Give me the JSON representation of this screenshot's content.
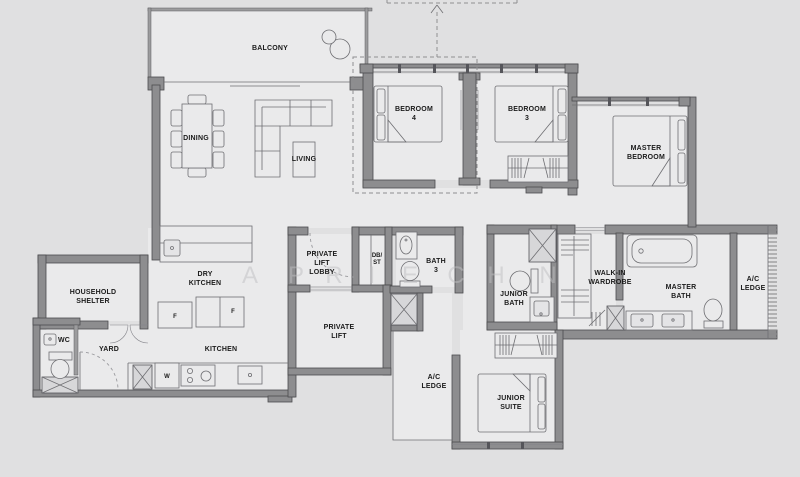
{
  "plan": {
    "background": "#e0e0e1",
    "floor_color": "#eaeaeb",
    "wall_color": "#8d8d8f",
    "text_color": "#1b1b1b"
  },
  "rooms": {
    "balcony": {
      "label": "BALCONY"
    },
    "dining": {
      "label": "DINING"
    },
    "living": {
      "label": "LIVING"
    },
    "bedroom4": {
      "l1": "BEDROOM",
      "l2": "4"
    },
    "bedroom3": {
      "l1": "BEDROOM",
      "l2": "3"
    },
    "master_bedroom": {
      "l1": "MASTER",
      "l2": "BEDROOM"
    },
    "household_shelter": {
      "l1": "HOUSEHOLD",
      "l2": "SHELTER"
    },
    "dry_kitchen": {
      "l1": "DRY",
      "l2": "KITCHEN"
    },
    "wc": {
      "label": "WC"
    },
    "yard": {
      "label": "YARD"
    },
    "kitchen": {
      "label": "KITCHEN"
    },
    "private_lift_lobby": {
      "l1": "PRIVATE",
      "l2": "LIFT",
      "l3": "LOBBY"
    },
    "db_st": {
      "l1": "DB/",
      "l2": "ST"
    },
    "bath3": {
      "l1": "BATH",
      "l2": "3"
    },
    "private_lift": {
      "l1": "PRIVATE",
      "l2": "LIFT"
    },
    "ac_ledge_center": {
      "l1": "A/C",
      "l2": "LEDGE"
    },
    "junior_bath": {
      "l1": "JUNIOR",
      "l2": "BATH"
    },
    "walk_in_wardrobe": {
      "l1": "WALK-IN",
      "l2": "WARDROBE"
    },
    "master_bath": {
      "l1": "MASTER",
      "l2": "BATH"
    },
    "ac_ledge_right": {
      "l1": "A/C",
      "l2": "LEDGE"
    },
    "junior_suite": {
      "l1": "JUNIOR",
      "l2": "SUITE"
    }
  },
  "appliances": {
    "fridge1": "F",
    "fridge2": "F",
    "washer": "W"
  },
  "watermark": {
    "letters": [
      "A",
      "P",
      "R",
      "I",
      "E",
      "C",
      "H",
      "N"
    ]
  }
}
